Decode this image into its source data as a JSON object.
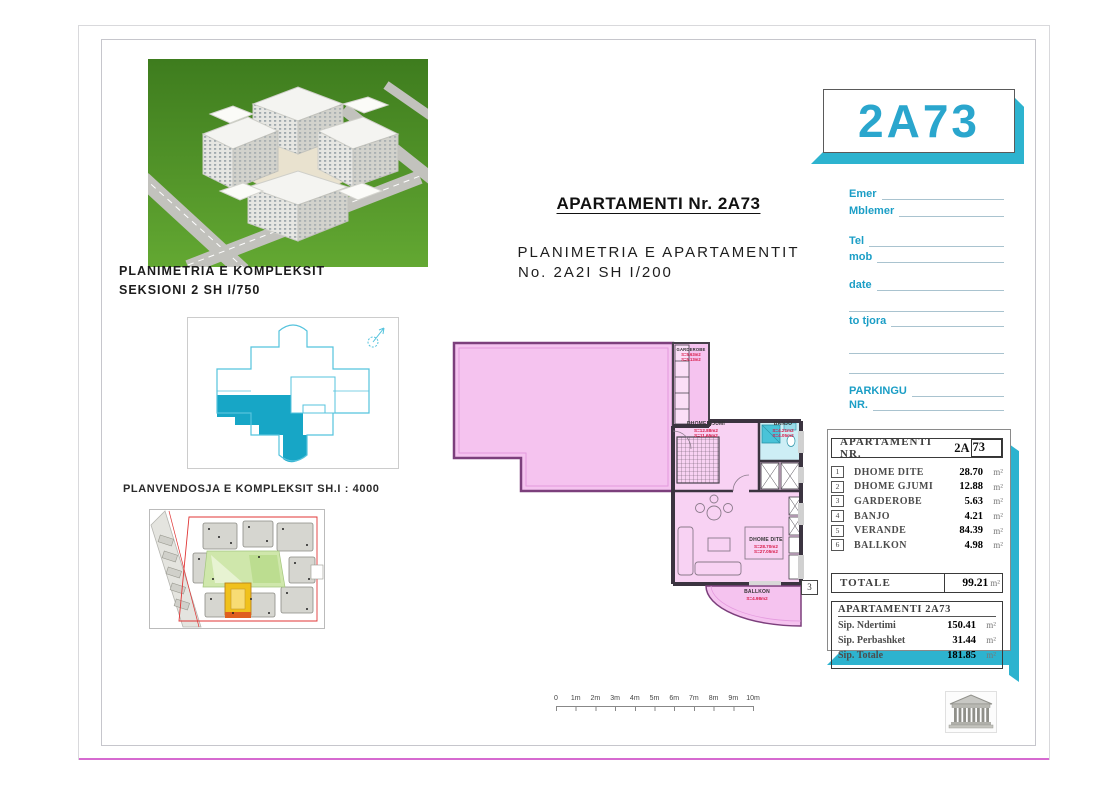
{
  "sheet": {
    "complex_photo_label": {
      "line1": "PLANIMETRIA E KOMPLEKSIT",
      "line2": "SEKSIONI 2  SH I/750"
    },
    "site_plan_label": "PLANVENDOSJA E KOMPLEKSIT SH.I : 4000",
    "title": {
      "main": "APARTAMENTI Nr. 2A73",
      "sub1": "PLANIMETRIA E APARTAMENTIT",
      "sub2": "No. 2A2I SH I/200"
    }
  },
  "floor_plan": {
    "rooms": [
      {
        "name": "GARDEROBE",
        "area1": "S=5.63m2",
        "area2": "S=5.13m2"
      },
      {
        "name": "DHOME GJUMI",
        "area1": "S=12.88m2",
        "area2": "S=11.65m2"
      },
      {
        "name": "BANJO",
        "area1": "S=4.21m2",
        "area2": "S=4.05m2"
      },
      {
        "name": "DHOME DITE",
        "area1": "S=28.70m2",
        "area2": "S=27.05m2"
      },
      {
        "name": "BALLKON",
        "area1": "S=4.98m2",
        "area2": ""
      }
    ],
    "marker": "3"
  },
  "scale_bar": {
    "ticks": [
      "0",
      "1m",
      "2m",
      "3m",
      "4m",
      "5m",
      "6m",
      "7m",
      "8m",
      "9m",
      "10m"
    ]
  },
  "panel": {
    "unit_code": "2A73",
    "form": {
      "f1": "Emer",
      "f2": "Mblemer",
      "f3": "Tel",
      "f4": "mob",
      "f5": "date",
      "f6": "to tjora",
      "f7": "PARKINGU",
      "f8": "NR."
    },
    "table1": {
      "header_label": "APARTAMENTI  NR.",
      "value_prefix": "2A",
      "value_boxed": "73",
      "rows": [
        {
          "num": "1",
          "label": "DHOME DITE",
          "value": "28.70",
          "unit": "m²"
        },
        {
          "num": "2",
          "label": "DHOME GJUMI",
          "value": "12.88",
          "unit": "m²"
        },
        {
          "num": "3",
          "label": "GARDEROBE",
          "value": "5.63",
          "unit": "m²"
        },
        {
          "num": "4",
          "label": "BANJO",
          "value": "4.21",
          "unit": "m²"
        },
        {
          "num": "5",
          "label": "VERANDE",
          "value": "84.39",
          "unit": "m²"
        },
        {
          "num": "6",
          "label": "BALLKON",
          "value": "4.98",
          "unit": "m²"
        }
      ],
      "total_label": "TOTALE",
      "total_value": "99.21",
      "total_unit": "m²"
    },
    "table2": {
      "header": "APARTAMENTI 2A73",
      "rows": [
        {
          "label": "Sip. Ndertimi",
          "value": "150.41",
          "unit": "m²"
        },
        {
          "label": "Sip. Perbashket",
          "value": "31.44",
          "unit": "m²"
        },
        {
          "label": "Sip. Totale",
          "value": "181.85",
          "unit": "m²"
        }
      ]
    }
  },
  "colors": {
    "accent_cyan": "#29a7cc",
    "shadow_teal": "#2db3cf",
    "plan_pink": "#f5c3ef",
    "label_red": "#d81b4a"
  }
}
